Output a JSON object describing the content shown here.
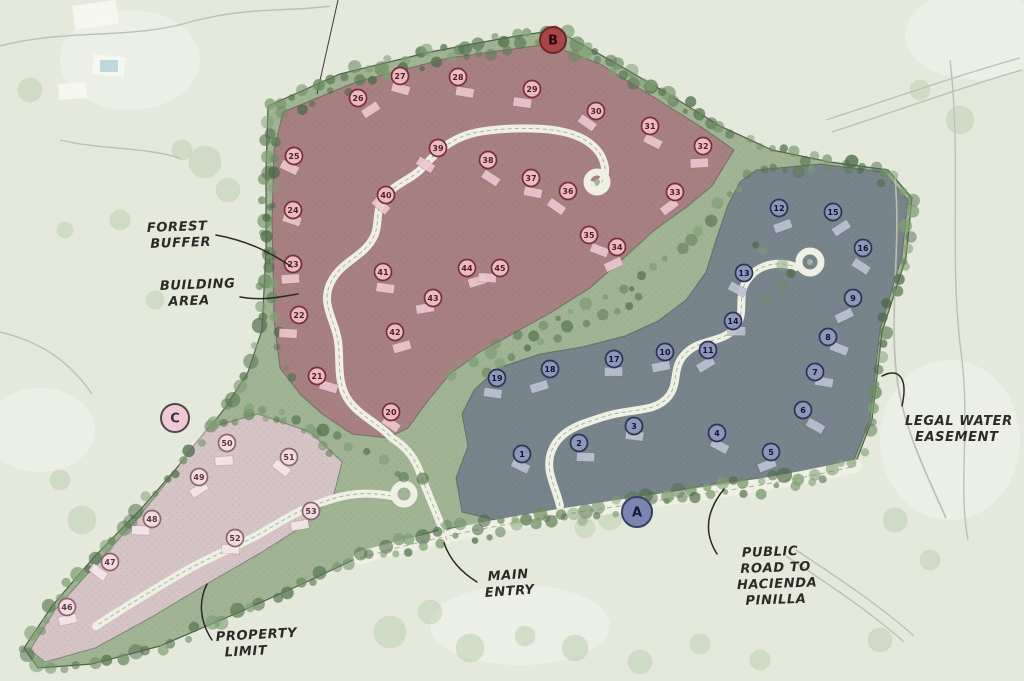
{
  "map": {
    "kind": "hand-drawn residential master site plan",
    "colors": {
      "background": "#e4e9dc",
      "site_green": "#a0b494",
      "boundary_ink": "#4f6148",
      "road": "#eef0e3",
      "road_center": "#a8ad9e",
      "ink": "#2b2a26",
      "zone_b_fill": "#a87e81",
      "zone_a_fill": "#75828b",
      "zone_c_fill": "#d9c4c9"
    },
    "markers": [
      {
        "id": "marker-b",
        "label": "B",
        "x": 553,
        "y": 40,
        "r": 13,
        "fill": "#a64648",
        "ring": "#6f2527",
        "text": "#2a0a0b"
      },
      {
        "id": "marker-a",
        "label": "A",
        "x": 637,
        "y": 512,
        "r": 15,
        "fill": "#7b85b0",
        "ring": "#394069",
        "text": "#14183a"
      },
      {
        "id": "marker-c",
        "label": "C",
        "x": 175,
        "y": 418,
        "r": 14,
        "fill": "#f3c8d6",
        "ring": "#4a4a4a",
        "text": "#333333"
      }
    ],
    "zones": [
      {
        "id": "zone-b",
        "marker": "B",
        "fill": "#a87e81",
        "lot_ring": "#7b2e35",
        "lot_fill": "#e9bcc4",
        "lot_text": "#571c23",
        "house_fill": "#ecc9cf",
        "outline": [
          [
            283,
            112
          ],
          [
            356,
            82
          ],
          [
            448,
            58
          ],
          [
            548,
            44
          ],
          [
            600,
            64
          ],
          [
            652,
            96
          ],
          [
            706,
            130
          ],
          [
            734,
            150
          ],
          [
            712,
            186
          ],
          [
            688,
            206
          ],
          [
            652,
            232
          ],
          [
            624,
            258
          ],
          [
            590,
            288
          ],
          [
            552,
            312
          ],
          [
            516,
            332
          ],
          [
            480,
            352
          ],
          [
            450,
            374
          ],
          [
            430,
            398
          ],
          [
            408,
            428
          ],
          [
            388,
            438
          ],
          [
            352,
            434
          ],
          [
            322,
            414
          ],
          [
            300,
            394
          ],
          [
            280,
            368
          ],
          [
            274,
            320
          ],
          [
            272,
            220
          ],
          [
            274,
            150
          ]
        ],
        "lots": [
          {
            "n": 20,
            "x": 391,
            "y": 412
          },
          {
            "n": 21,
            "x": 317,
            "y": 376
          },
          {
            "n": 22,
            "x": 299,
            "y": 315
          },
          {
            "n": 23,
            "x": 293,
            "y": 264
          },
          {
            "n": 24,
            "x": 293,
            "y": 210
          },
          {
            "n": 25,
            "x": 294,
            "y": 156
          },
          {
            "n": 26,
            "x": 358,
            "y": 98
          },
          {
            "n": 27,
            "x": 400,
            "y": 76
          },
          {
            "n": 28,
            "x": 458,
            "y": 77
          },
          {
            "n": 29,
            "x": 532,
            "y": 89
          },
          {
            "n": 30,
            "x": 596,
            "y": 111
          },
          {
            "n": 31,
            "x": 650,
            "y": 126
          },
          {
            "n": 32,
            "x": 703,
            "y": 146
          },
          {
            "n": 33,
            "x": 675,
            "y": 192
          },
          {
            "n": 34,
            "x": 617,
            "y": 247
          },
          {
            "n": 35,
            "x": 589,
            "y": 235
          },
          {
            "n": 36,
            "x": 568,
            "y": 191
          },
          {
            "n": 37,
            "x": 531,
            "y": 178
          },
          {
            "n": 38,
            "x": 488,
            "y": 160
          },
          {
            "n": 39,
            "x": 438,
            "y": 148
          },
          {
            "n": 40,
            "x": 386,
            "y": 195
          },
          {
            "n": 41,
            "x": 383,
            "y": 272
          },
          {
            "n": 42,
            "x": 395,
            "y": 332
          },
          {
            "n": 43,
            "x": 433,
            "y": 298
          },
          {
            "n": 44,
            "x": 467,
            "y": 268
          },
          {
            "n": 45,
            "x": 500,
            "y": 268
          }
        ]
      },
      {
        "id": "zone-a",
        "marker": "A",
        "fill": "#75828b",
        "lot_ring": "#2c3456",
        "lot_fill": "#8e97b8",
        "lot_text": "#101432",
        "house_fill": "#bcc3d3",
        "outline": [
          [
            756,
            170
          ],
          [
            820,
            164
          ],
          [
            884,
            172
          ],
          [
            908,
            200
          ],
          [
            902,
            256
          ],
          [
            880,
            330
          ],
          [
            870,
            420
          ],
          [
            854,
            460
          ],
          [
            798,
            475
          ],
          [
            730,
            481
          ],
          [
            652,
            495
          ],
          [
            572,
            509
          ],
          [
            498,
            521
          ],
          [
            462,
            512
          ],
          [
            456,
            478
          ],
          [
            468,
            446
          ],
          [
            462,
            414
          ],
          [
            474,
            390
          ],
          [
            498,
            368
          ],
          [
            540,
            354
          ],
          [
            582,
            347
          ],
          [
            625,
            336
          ],
          [
            658,
            321
          ],
          [
            686,
            300
          ],
          [
            706,
            272
          ],
          [
            716,
            240
          ],
          [
            728,
            205
          ],
          [
            740,
            182
          ]
        ],
        "lots": [
          {
            "n": 1,
            "x": 522,
            "y": 454
          },
          {
            "n": 2,
            "x": 579,
            "y": 443
          },
          {
            "n": 3,
            "x": 634,
            "y": 426
          },
          {
            "n": 4,
            "x": 717,
            "y": 433
          },
          {
            "n": 5,
            "x": 771,
            "y": 452
          },
          {
            "n": 6,
            "x": 803,
            "y": 410
          },
          {
            "n": 7,
            "x": 815,
            "y": 372
          },
          {
            "n": 8,
            "x": 828,
            "y": 337
          },
          {
            "n": 9,
            "x": 853,
            "y": 298
          },
          {
            "n": 10,
            "x": 665,
            "y": 352
          },
          {
            "n": 11,
            "x": 708,
            "y": 350
          },
          {
            "n": 12,
            "x": 779,
            "y": 208
          },
          {
            "n": 13,
            "x": 744,
            "y": 273
          },
          {
            "n": 14,
            "x": 733,
            "y": 321
          },
          {
            "n": 15,
            "x": 833,
            "y": 212
          },
          {
            "n": 16,
            "x": 863,
            "y": 248
          },
          {
            "n": 17,
            "x": 614,
            "y": 359
          },
          {
            "n": 18,
            "x": 550,
            "y": 369
          },
          {
            "n": 19,
            "x": 497,
            "y": 378
          }
        ]
      },
      {
        "id": "zone-c",
        "marker": "C",
        "fill": "#d9c4c9",
        "lot_ring": "#8d6570",
        "lot_fill": "#f2dce2",
        "lot_text": "#5c3540",
        "house_fill": "#f6e7ea",
        "outline": [
          [
            208,
            428
          ],
          [
            258,
            414
          ],
          [
            310,
            432
          ],
          [
            342,
            462
          ],
          [
            334,
            494
          ],
          [
            306,
            524
          ],
          [
            262,
            552
          ],
          [
            210,
            582
          ],
          [
            150,
            618
          ],
          [
            95,
            648
          ],
          [
            45,
            662
          ],
          [
            30,
            650
          ],
          [
            55,
            610
          ],
          [
            98,
            562
          ],
          [
            138,
            518
          ],
          [
            170,
            478
          ],
          [
            190,
            450
          ]
        ],
        "lots": [
          {
            "n": 46,
            "x": 67,
            "y": 607
          },
          {
            "n": 47,
            "x": 110,
            "y": 562
          },
          {
            "n": 48,
            "x": 152,
            "y": 519
          },
          {
            "n": 49,
            "x": 199,
            "y": 477
          },
          {
            "n": 50,
            "x": 227,
            "y": 443
          },
          {
            "n": 51,
            "x": 289,
            "y": 457
          },
          {
            "n": 52,
            "x": 235,
            "y": 538
          },
          {
            "n": 53,
            "x": 311,
            "y": 511
          }
        ]
      }
    ],
    "site_outline": [
      [
        268,
        106
      ],
      [
        340,
        74
      ],
      [
        430,
        52
      ],
      [
        505,
        38
      ],
      [
        556,
        30
      ],
      [
        610,
        60
      ],
      [
        665,
        92
      ],
      [
        720,
        126
      ],
      [
        772,
        150
      ],
      [
        830,
        162
      ],
      [
        888,
        170
      ],
      [
        912,
        198
      ],
      [
        906,
        258
      ],
      [
        882,
        332
      ],
      [
        872,
        420
      ],
      [
        856,
        462
      ],
      [
        800,
        477
      ],
      [
        732,
        483
      ],
      [
        655,
        497
      ],
      [
        575,
        510
      ],
      [
        498,
        522
      ],
      [
        438,
        530
      ],
      [
        370,
        552
      ],
      [
        300,
        585
      ],
      [
        235,
        614
      ],
      [
        160,
        646
      ],
      [
        92,
        664
      ],
      [
        38,
        668
      ],
      [
        24,
        648
      ],
      [
        52,
        606
      ],
      [
        95,
        556
      ],
      [
        140,
        510
      ],
      [
        175,
        470
      ],
      [
        200,
        440
      ],
      [
        225,
        408
      ],
      [
        248,
        372
      ],
      [
        262,
        330
      ],
      [
        266,
        250
      ],
      [
        266,
        170
      ]
    ],
    "roads": {
      "main_entry": "M447,540 C436,512 427,492 419,470 C412,452 401,444 392,438",
      "red_loop": "M390,436 C374,420 352,412 344,392 C336,372 342,352 336,332 C330,312 322,300 331,282 C341,262 362,257 372,240 C381,226 374,212 384,198 C395,183 413,179 423,167 C437,152 449,140 470,134 C492,128 538,126 564,132 C590,138 603,152 605,168 C606,180 599,188 591,185",
      "blue_loop": "M560,506 C555,484 544,470 552,450 C561,429 582,424 603,417 C630,408 655,413 668,397 C680,383 671,367 686,353 C700,339 722,343 734,329 C748,313 735,295 748,279 C761,261 783,262 796,267",
      "pink_road": "M392,496 C358,490 338,496 312,506 C286,516 270,530 244,542 C217,555 196,564 170,580 C145,595 120,610 96,626",
      "public_road": "M360,558 C450,532 540,518 620,506 C700,494 770,486 856,466",
      "easement_line": "M895,178 C902,250 886,330 900,396 C908,436 928,478 946,518",
      "survey_line": "M338,0 L317,94",
      "culdesacs": [
        {
          "x": 597,
          "y": 182,
          "r": 10
        },
        {
          "x": 810,
          "y": 262,
          "r": 11
        },
        {
          "x": 404,
          "y": 494,
          "r": 10
        }
      ]
    },
    "annotations": [
      {
        "id": "forest-buffer",
        "lines": [
          "FOREST",
          "BUFFER"
        ],
        "x": 147,
        "y": 232,
        "indents": [
          0,
          3
        ],
        "rotate": -2,
        "leader": "M216,235 C248,241 268,251 292,267"
      },
      {
        "id": "building-area",
        "lines": [
          "BUILDING",
          "AREA"
        ],
        "x": 160,
        "y": 290,
        "indents": [
          0,
          8
        ],
        "rotate": -2,
        "leader": "M240,297 C264,301 278,297 298,294"
      },
      {
        "id": "legal-water-easement",
        "lines": [
          "LEGAL WATER",
          "EASEMENT"
        ],
        "x": 905,
        "y": 425,
        "indents": [
          0,
          10
        ],
        "rotate": 0,
        "leader": "M882,376 C900,367 908,379 902,406"
      },
      {
        "id": "main-entry",
        "lines": [
          "MAIN",
          "ENTRY"
        ],
        "x": 484,
        "y": 581,
        "indents": [
          4,
          0
        ],
        "rotate": -4,
        "leader": "M444,543 C450,560 461,572 477,582"
      },
      {
        "id": "public-road-to-hacienda-pinilla",
        "lines": [
          "PUBLIC",
          "ROAD TO",
          "HACIENDA",
          "PINILLA"
        ],
        "x": 740,
        "y": 557,
        "indents": [
          2,
          0,
          -4,
          4
        ],
        "rotate": -2,
        "leader": "M724,489 C707,510 703,532 717,554"
      },
      {
        "id": "property-limit",
        "lines": [
          "PROPERTY",
          "LIMIT"
        ],
        "x": 216,
        "y": 641,
        "indents": [
          0,
          8
        ],
        "rotate": -3,
        "leader": "M212,640 C200,622 198,602 207,584"
      }
    ]
  }
}
